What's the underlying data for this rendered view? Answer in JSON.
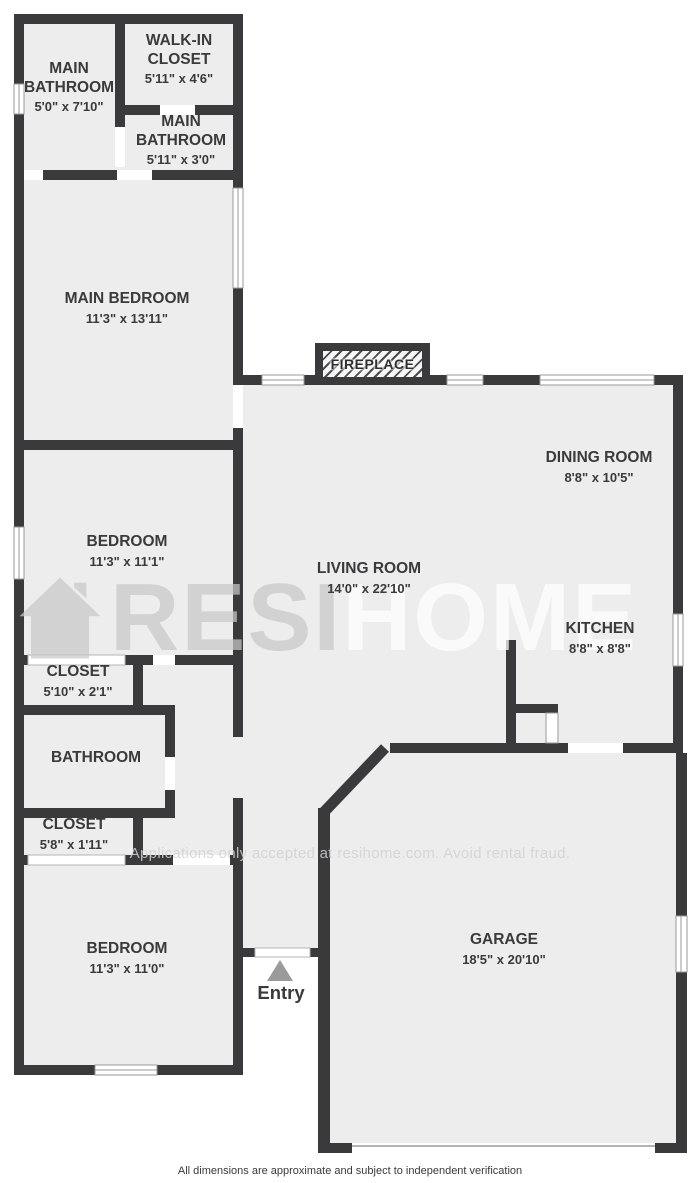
{
  "colors": {
    "wall": "#3a3a3c",
    "room_fill": "#ededed",
    "window_line": "#9a9a9a",
    "entry_arrow": "#9b9b9d",
    "watermark_gray": "#c9c9c9",
    "watermark_white": "#ffffff"
  },
  "rooms": [
    {
      "name": "MAIN BATHROOM",
      "dims": "5'0\" x 7'10\""
    },
    {
      "name": "WALK-IN CLOSET",
      "dims": "5'11\" x 4'6\""
    },
    {
      "name": "MAIN BATHROOM",
      "dims": "5'11\" x 3'0\""
    },
    {
      "name": "MAIN BEDROOM",
      "dims": "11'3\" x 13'11\""
    },
    {
      "name": "DINING ROOM",
      "dims": "8'8\" x 10'5\""
    },
    {
      "name": "BEDROOM",
      "dims": "11'3\" x 11'1\""
    },
    {
      "name": "LIVING ROOM",
      "dims": "14'0\" x 22'10\""
    },
    {
      "name": "KITCHEN",
      "dims": "8'8\" x 8'8\""
    },
    {
      "name": "CLOSET",
      "dims": "5'10\" x 2'1\""
    },
    {
      "name": "BATHROOM",
      "dims": ""
    },
    {
      "name": "CLOSET",
      "dims": "5'8\" x 1'11\""
    },
    {
      "name": "BEDROOM",
      "dims": "11'3\" x 11'0\""
    },
    {
      "name": "GARAGE",
      "dims": "18'5\" x 20'10\""
    }
  ],
  "features": {
    "fireplace": "FIREPLACE",
    "entry": "Entry"
  },
  "watermark": {
    "brand_resi": "RESI",
    "brand_home": "HOME",
    "notice": "Applications only accepted at resihome.com. Avoid rental fraud."
  },
  "footer": {
    "disclaimer": "All dimensions are approximate and subject to independent verification"
  }
}
